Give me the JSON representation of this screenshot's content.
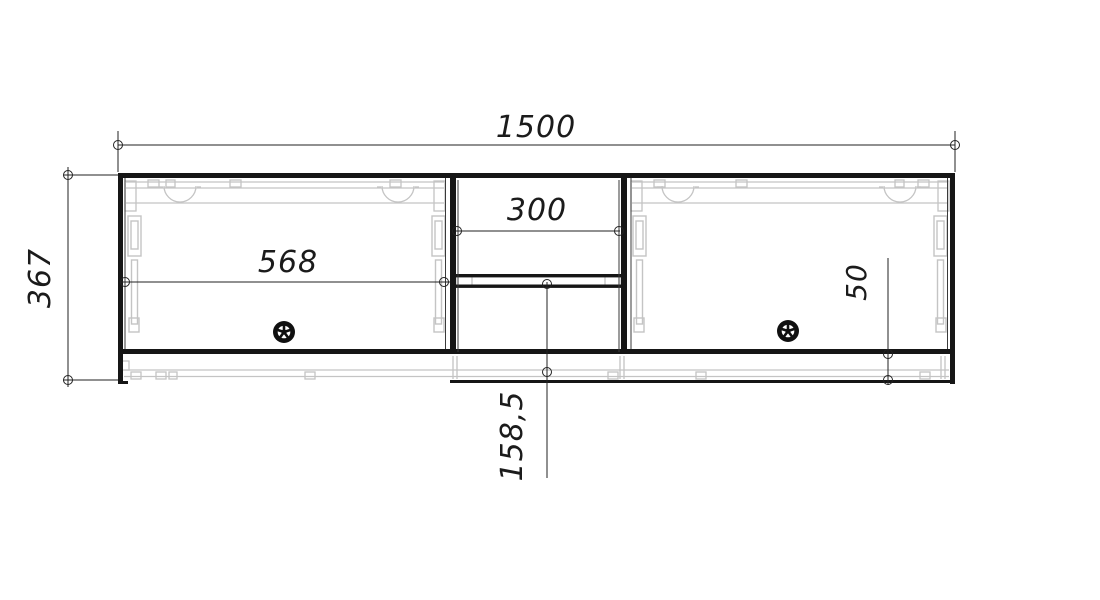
{
  "drawing": {
    "type": "furniture-front-view-technical-drawing",
    "labels": {
      "overall_width": "1500",
      "overall_height": "367",
      "left_door_width": "568",
      "niche_width": "300",
      "bottom_recess_height": "50",
      "niche_lower_compartment_height": "158,5"
    },
    "colors": {
      "structure_line": "#161616",
      "dimension_line": "#222222",
      "hardware_line": "#c4c4c4",
      "background": "#ffffff"
    }
  }
}
